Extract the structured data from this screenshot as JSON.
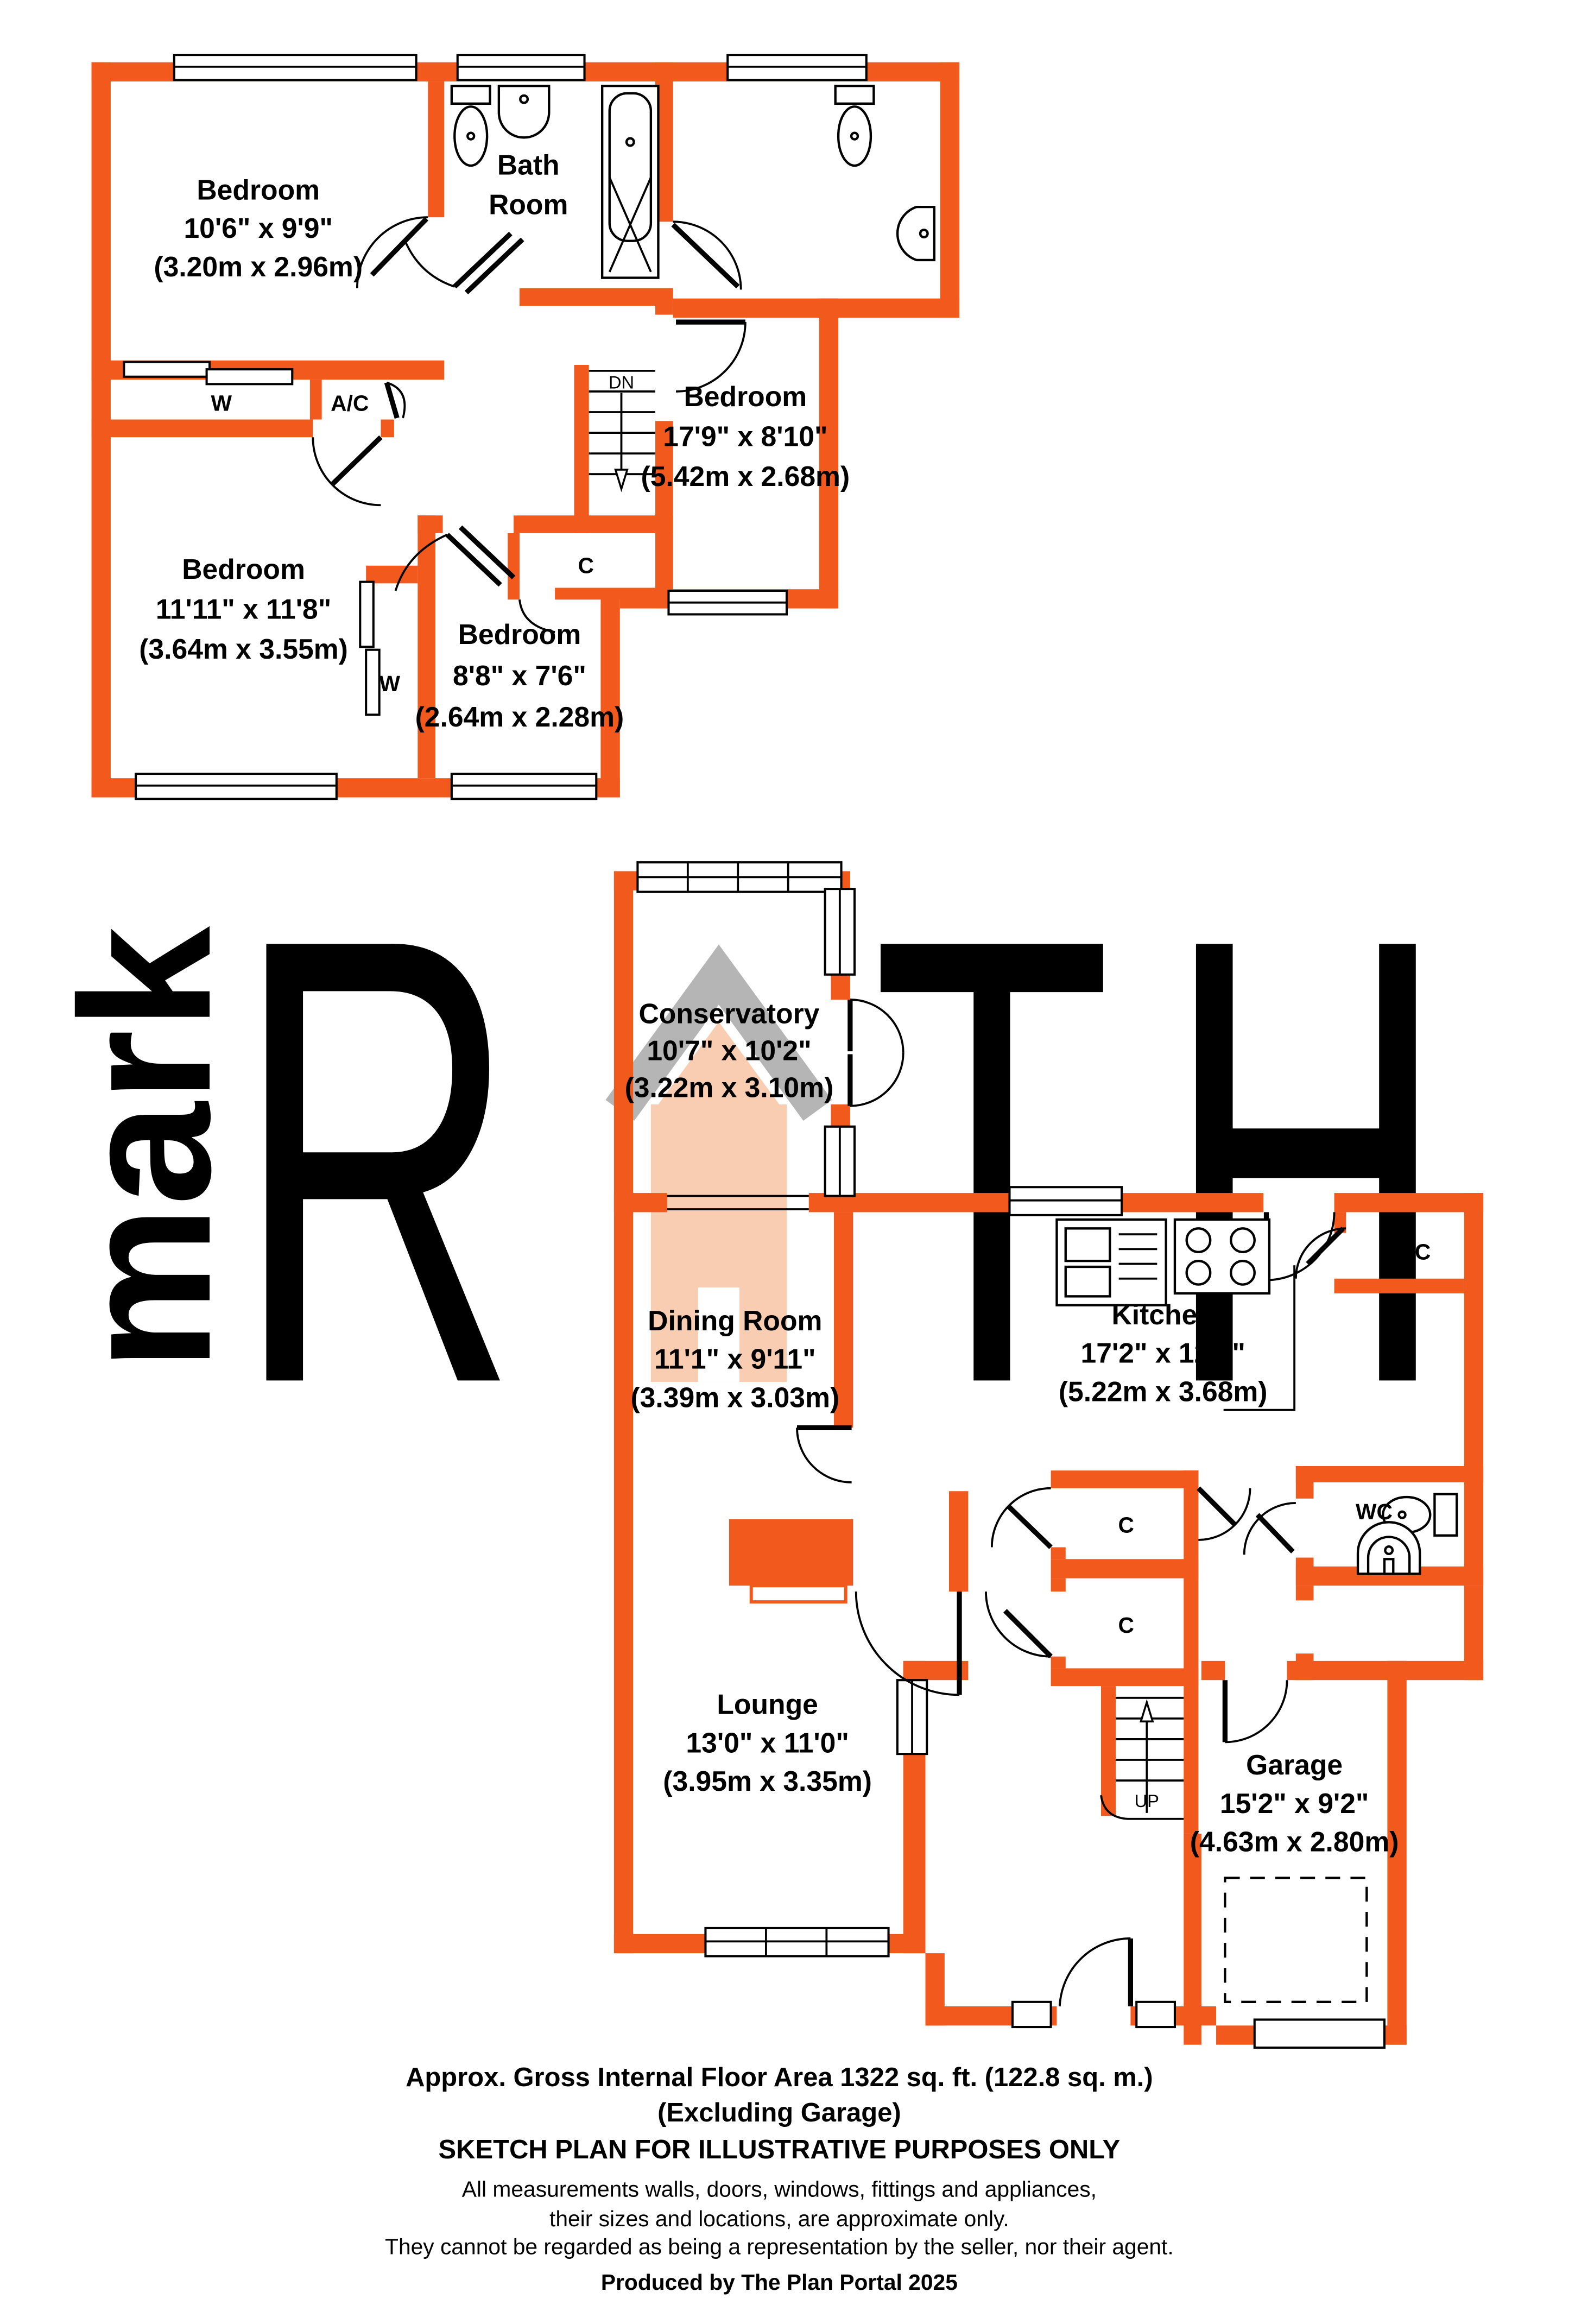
{
  "first_floor": {
    "bedroom_1": {
      "name": "Bedroom",
      "size_imperial": "10'6\" x 9'9\"",
      "size_metric": "(3.20m x 2.96m)"
    },
    "bathroom": {
      "line1": "Bath",
      "line2": "Room"
    },
    "bedroom_2": {
      "name": "Bedroom",
      "size_imperial": "17'9\" x 8'10\"",
      "size_metric": "(5.42m x 2.68m)"
    },
    "bedroom_3": {
      "name": "Bedroom",
      "size_imperial": "11'11\" x 11'8\"",
      "size_metric": "(3.64m x 3.55m)"
    },
    "bedroom_4": {
      "name": "Bedroom",
      "size_imperial": "8'8\" x 7'6\"",
      "size_metric": "(2.64m x 2.28m)"
    },
    "wardrobe_label": "W",
    "wardrobe_2_label": "W",
    "airing_cupboard_label": "A/C",
    "cupboard_label": "C",
    "stairs_down_label": "DN"
  },
  "ground_floor": {
    "conservatory": {
      "name": "Conservatory",
      "size_imperial": "10'7\" x 10'2\"",
      "size_metric": "(3.22m x 3.10m)"
    },
    "dining_room": {
      "name": "Dining Room",
      "size_imperial": "11'1\" x 9'11\"",
      "size_metric": "(3.39m x 3.03m)"
    },
    "kitchen": {
      "name": "Kitchen",
      "size_imperial": "17'2\" x 12'1\"",
      "size_metric": "(5.22m x 3.68m)"
    },
    "lounge": {
      "name": "Lounge",
      "size_imperial": "13'0\" x 11'0\"",
      "size_metric": "(3.95m x 3.35m)"
    },
    "garage": {
      "name": "Garage",
      "size_imperial": "15'2\" x 9'2\"",
      "size_metric": "(4.63m x 2.80m)"
    },
    "wc_label": "WC",
    "cupboard_kitchen_label": "C",
    "cupboard_hall_1_label": "C",
    "cupboard_hall_2_label": "C",
    "stairs_up_label": "UP"
  },
  "watermark": {
    "vertical_text": "mark",
    "letter_r": "R",
    "letter_t": "T",
    "letter_h": "H"
  },
  "footer": {
    "area_line": "Approx. Gross Internal Floor Area 1322 sq. ft. (122.8 sq. m.)",
    "excluding_line": "(Excluding Garage)",
    "sketch_line": "SKETCH PLAN FOR ILLUSTRATIVE PURPOSES ONLY",
    "disclaimer_1": "All measurements walls, doors, windows, fittings and appliances,",
    "disclaimer_2": "their sizes and locations, are approximate only.",
    "disclaimer_3": "They cannot be regarded as being a representation by the seller, nor their agent.",
    "produced_line": "Produced by The Plan Portal 2025"
  },
  "colors": {
    "wall": "#F2591C",
    "watermark_peach": "#F9CDB2",
    "watermark_gray": "#C8C8C8"
  }
}
